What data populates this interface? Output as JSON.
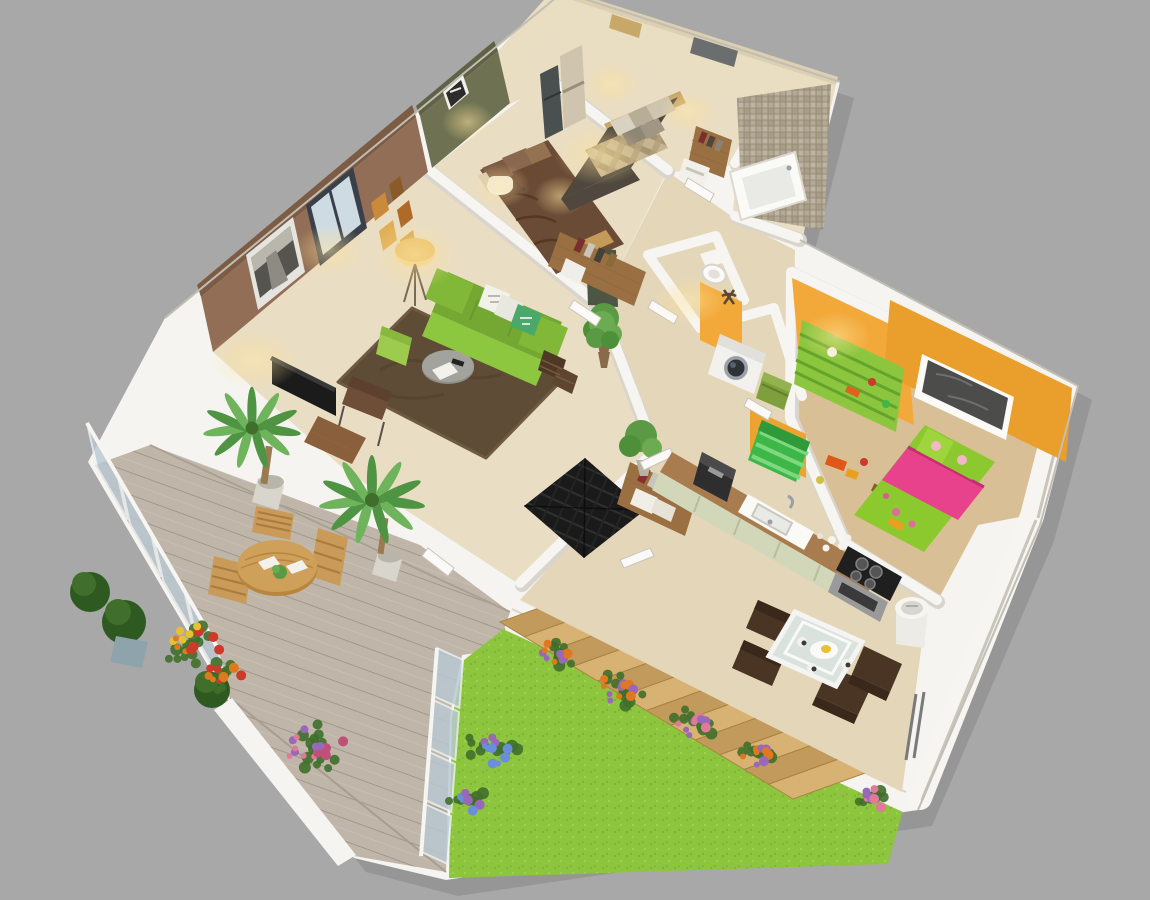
{
  "scene": {
    "kind": "3d-isometric-floor-plan-render",
    "background": "#a8a8a8",
    "building_shadow": "rgba(0,0,0,0.10)"
  },
  "palette": {
    "wall_white": "#f5f4f0",
    "wall_edge": "#dcd8cf",
    "floor_tan": "#e9ddc3",
    "floor_mid": "#e4d6b8",
    "floor_kids": "#d8bf95",
    "rug_brown": "#5f4c36",
    "rug_dark": "#52402c",
    "wall_brown": "#916e55",
    "wall_olive": "#6f7252",
    "wall_beige": "#e9ddc2",
    "wall_orange": "#f2a93a",
    "wall_orange_dark": "#ea9e2b",
    "mosaic": "#b3a995",
    "sofa_green": "#8dc63f",
    "sofa_dark": "#74a832",
    "pouf_green": "#9ccb4d",
    "armchair_brown": "#6f4e38",
    "tv_black": "#1b1b1b",
    "master_bed": "#50483e",
    "plaid_light": "#c6b492",
    "plaid_dark": "#a6936f",
    "headboard_tan": "#c8a568",
    "bed2_brown": "#6a4b36",
    "kids_bed_green": "#8bc92f",
    "kids_pink": "#e8428c",
    "kids_shelf": "#8cc63e",
    "toybox_green": "#3db848",
    "deck_wood": "#bfb6a9",
    "deck_line": "#968e82",
    "outdoor_wood": "#c99a58",
    "grass_green": "#8dc63e",
    "grass_dark": "#7db436",
    "railing_glass": "#b9c9d4",
    "stairs_wood": "#d7b273",
    "stairs_wood_dark": "#c29a5b",
    "counter_wood": "#a97c4f",
    "cabinet_sage": "#d3d7ba",
    "glass_table": "#d9e2dd",
    "chair_dark": "#4a3525",
    "mat_black": "#1a1a1a",
    "washer_white": "#f2f1ee",
    "plant_green": "#4e8f3a",
    "palm_green": "#6fb45c",
    "palm_dark": "#4e9443",
    "leaf_dark": "#3f6f2a",
    "flower_orange": "#e07820",
    "flower_red": "#cc3a2a",
    "flower_yellow": "#e8c030",
    "flower_pink": "#e0799a",
    "flower_magenta": "#c05078",
    "flower_purple": "#9a68b8",
    "flower_blue": "#6a8fd8",
    "glow_warm": "#ffe8ab"
  },
  "rooms": [
    {
      "name": "master-bedroom",
      "items": [
        "double-bed",
        "plaid-bedding",
        "headboard",
        "pillows",
        "wall-sconces",
        "art-panel",
        "window",
        "wardrobe-shelves",
        "towel-stand"
      ]
    },
    {
      "name": "bathroom",
      "items": [
        "mosaic-tile-wall",
        "bathtub"
      ]
    },
    {
      "name": "bedroom-2",
      "items": [
        "double-bed-brown",
        "pillows",
        "drum-lamp",
        "olive-walls",
        "wall-art",
        "wardrobe-shelves",
        "closet-books"
      ]
    },
    {
      "name": "living-room",
      "items": [
        "green-sofa",
        "throw-pillows",
        "green-pouf",
        "round-coffee-table",
        "shag-rug",
        "armchair",
        "tv",
        "tv-cabinet",
        "tripod-floor-lamp",
        "city-photo",
        "gallery-frames",
        "window",
        "wicker-baskets",
        "potted-plant"
      ]
    },
    {
      "name": "hallway-entry",
      "items": [
        "black-doormat",
        "bookshelf",
        "potted-plant",
        "open-doors"
      ]
    },
    {
      "name": "wc",
      "items": [
        "toilet",
        "towel-stand"
      ]
    },
    {
      "name": "laundry",
      "items": [
        "washing-machine",
        "laundry-basket"
      ]
    },
    {
      "name": "kids-room",
      "items": [
        "kids-bed",
        "pink-blanket",
        "cartoon-pillows",
        "toy-shelf",
        "toy-box",
        "toys",
        "dark-window",
        "orange-walls"
      ]
    },
    {
      "name": "kitchen",
      "items": [
        "counter",
        "sink",
        "coffee-machine",
        "cups",
        "cooktop",
        "oven",
        "sage-cabinets",
        "trash-bin"
      ]
    },
    {
      "name": "dining",
      "items": [
        "glass-table",
        "four-dark-chairs",
        "plates",
        "centerpiece"
      ]
    },
    {
      "name": "terrace",
      "items": [
        "wood-deck",
        "frosted-glass-railing",
        "round-wood-table",
        "three-wood-chairs",
        "two-palm-plants",
        "boxwood-pots",
        "flower-planters"
      ]
    },
    {
      "name": "garden",
      "items": [
        "lawn",
        "wooden-stairs",
        "flower-border",
        "blue-hydrangeas",
        "shrubs"
      ]
    }
  ]
}
